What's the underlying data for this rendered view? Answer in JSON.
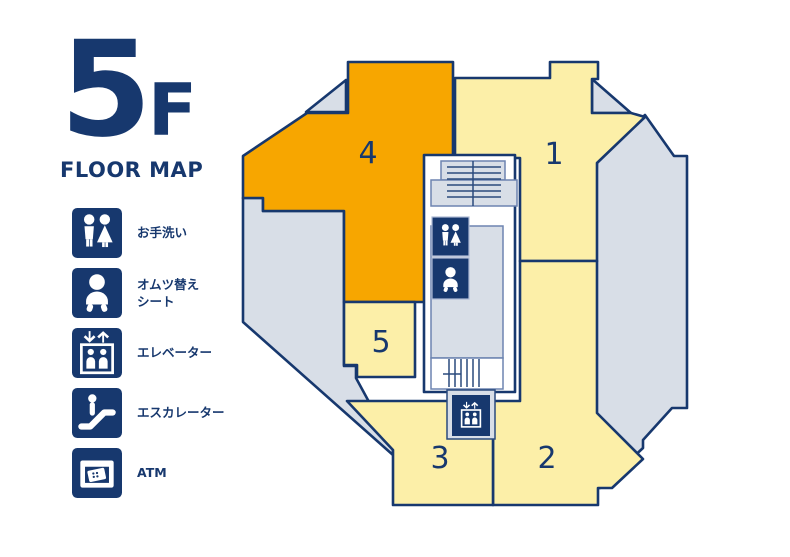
{
  "header": {
    "floor": "5",
    "floor_suffix": "F",
    "subtitle": "FLOOR MAP"
  },
  "legend": {
    "items": [
      {
        "icon": "restroom-icon",
        "label": "お手洗い"
      },
      {
        "icon": "diaper-changing-icon",
        "label": "オムツ替え\nシート"
      },
      {
        "icon": "elevator-icon",
        "label": "エレベーター"
      },
      {
        "icon": "escalator-icon",
        "label": "エスカレーター"
      },
      {
        "icon": "atm-icon",
        "label": "ATM"
      }
    ]
  },
  "map": {
    "areas": [
      {
        "id": "1",
        "label": "1"
      },
      {
        "id": "2",
        "label": "2"
      },
      {
        "id": "3",
        "label": "3"
      },
      {
        "id": "4",
        "label": "4"
      },
      {
        "id": "5",
        "label": "5"
      }
    ],
    "facilities": [
      "restroom",
      "diaper-changing",
      "elevator",
      "stairs",
      "escalator"
    ]
  },
  "colors": {
    "navy": "#17386E",
    "orange": "#F7A600",
    "yellow": "#FCEFA8",
    "gray": "#D8DEE7",
    "highlight_area": "4"
  }
}
